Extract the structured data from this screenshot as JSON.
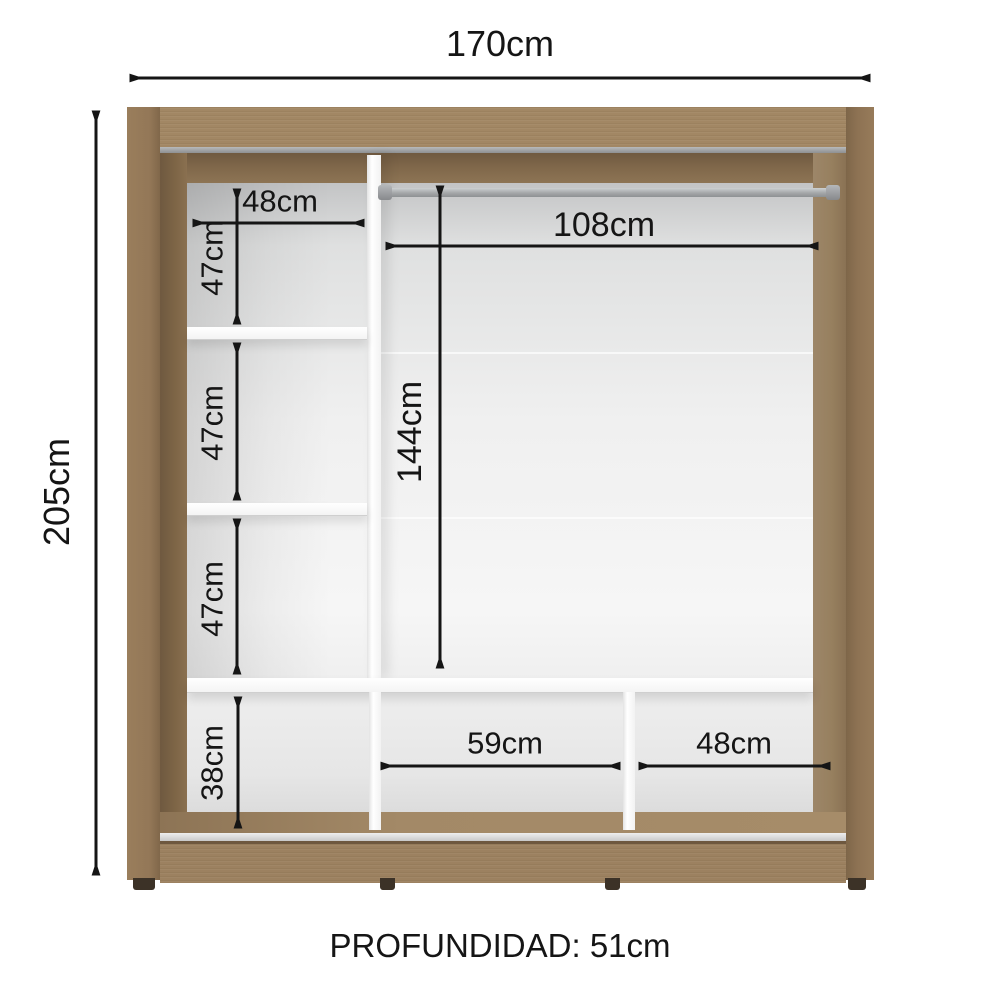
{
  "diagram": {
    "overall": {
      "width_label": "170cm",
      "height_label": "205cm",
      "depth_label": "PROFUNDIDAD: 51cm"
    },
    "left_column": {
      "width_label": "48cm",
      "sections": [
        {
          "label": "47cm"
        },
        {
          "label": "47cm"
        },
        {
          "label": "47cm"
        },
        {
          "label": "38cm"
        }
      ]
    },
    "right_section": {
      "rod_width_label": "108cm",
      "height_label": "144cm"
    },
    "bottom_row": {
      "middle_width_label": "59cm",
      "right_width_label": "48cm"
    }
  },
  "colors": {
    "wood_front": "#a28764",
    "wood_dark_edge": "#6b5640",
    "wood_bevel": "#7d6546",
    "interior_light": "#f3f3f3",
    "interior_shade": "#c6c7c8",
    "partition_white": "#fcfcfc",
    "rod_gray": "#a4a7a9",
    "annotation": "#151515",
    "background": "#ffffff"
  }
}
